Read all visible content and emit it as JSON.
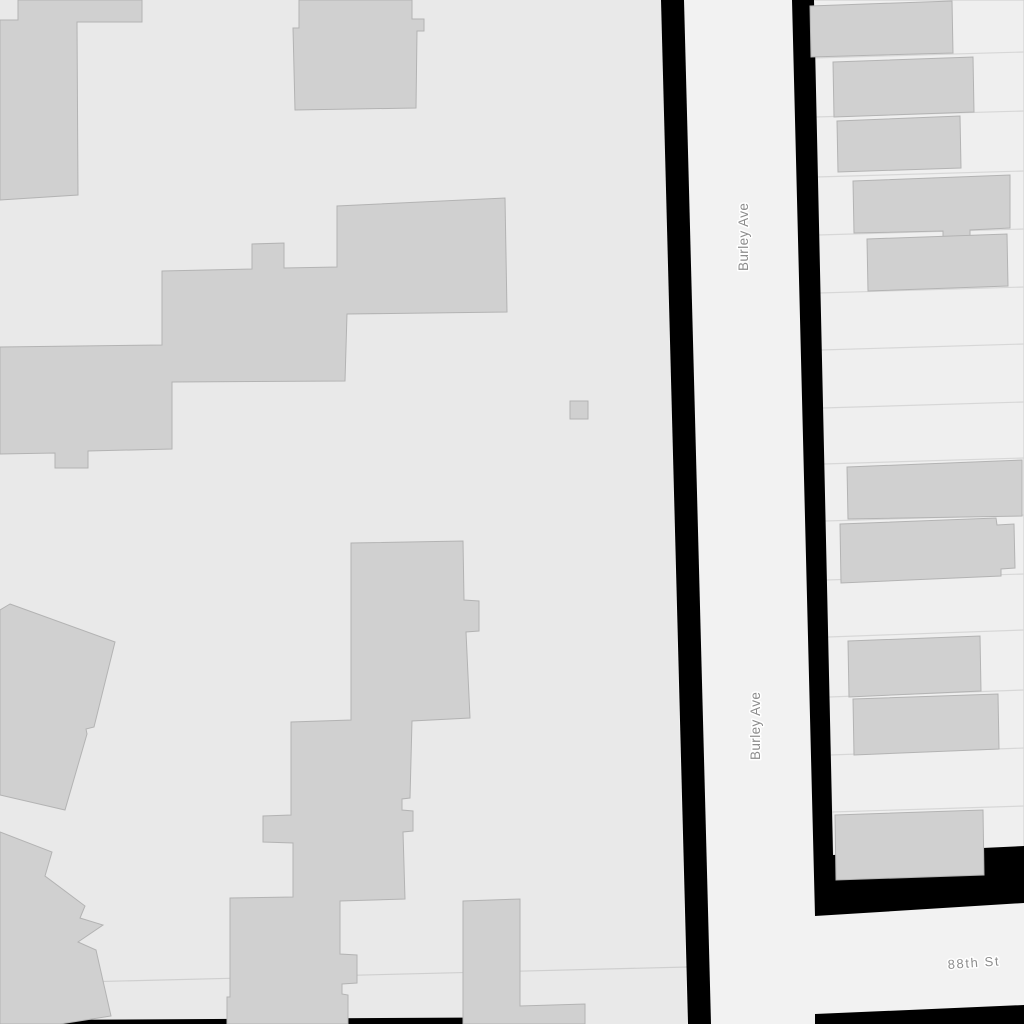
{
  "map": {
    "canvas": {
      "width": 1024,
      "height": 1024
    },
    "colors": {
      "background": "#e9e9e9",
      "road_fill": "#f2f2f2",
      "block_fill": "#efefef",
      "block_stroke": "#cccccc",
      "building_fill": "#d0d0d0",
      "building_stroke": "#b3b3b3",
      "casing": "#000000",
      "parcel_line": "#d7d7d7",
      "boundary_line": "#cfcfcf",
      "label_color": "#8c8c8c",
      "label_halo": "#ffffff"
    },
    "streets": {
      "burley_ave": {
        "name": "Burley Ave",
        "orientation": "vertical"
      },
      "eighty_eighth_st": {
        "name": "88th St",
        "orientation": "horizontal"
      }
    },
    "street_labels": [
      {
        "street": "burley-ave",
        "text": "Burley Ave",
        "x": 748,
        "y": 271,
        "rotate": -90,
        "size": 13.5,
        "spacing": 0.4
      },
      {
        "street": "burley-ave",
        "text": "Burley Ave",
        "x": 760,
        "y": 760,
        "rotate": -90,
        "size": 13.5,
        "spacing": 0.4
      },
      {
        "street": "88th-st",
        "text": "88th St",
        "x": 948,
        "y": 969,
        "rotate": -4,
        "size": 13,
        "spacing": 1.6
      }
    ],
    "roads": [
      {
        "name": "burley-ave-surface",
        "points": [
          [
            661,
            0
          ],
          [
            814,
            0
          ],
          [
            840,
            1024
          ],
          [
            687,
            1024
          ]
        ]
      },
      {
        "name": "88th-st-surface",
        "points": [
          [
            812,
            840
          ],
          [
            1024,
            833
          ],
          [
            1024,
            1024
          ],
          [
            816,
            1024
          ]
        ]
      }
    ],
    "blocks": [
      {
        "name": "east-block",
        "points": [
          [
            812,
            0
          ],
          [
            1024,
            0
          ],
          [
            1024,
            850
          ],
          [
            833,
            860
          ]
        ]
      }
    ],
    "parcel_lines": [
      [
        813,
        58,
        1024,
        52
      ],
      [
        815,
        117,
        1024,
        111
      ],
      [
        816,
        177,
        1024,
        171
      ],
      [
        818,
        235,
        1024,
        229
      ],
      [
        819,
        293,
        1024,
        287
      ],
      [
        821,
        350,
        1024,
        344
      ],
      [
        822,
        408,
        1024,
        402
      ],
      [
        823,
        464,
        1024,
        458
      ],
      [
        825,
        521,
        1024,
        515
      ],
      [
        826,
        580,
        1024,
        574
      ],
      [
        828,
        637,
        1024,
        630
      ],
      [
        829,
        697,
        1024,
        690
      ],
      [
        830,
        755,
        1024,
        748
      ],
      [
        832,
        812,
        1024,
        806
      ],
      [
        0,
        984,
        688,
        967
      ]
    ],
    "casings": [
      {
        "name": "burley-ave-casing-west",
        "points": [
          [
            661,
            0
          ],
          [
            684,
            0
          ],
          [
            711,
            1024
          ],
          [
            688,
            1024
          ]
        ]
      },
      {
        "name": "burley-ave-88th-casing-corner",
        "points": [
          [
            792,
            0
          ],
          [
            814,
            0
          ],
          [
            833,
            855
          ],
          [
            1024,
            846
          ],
          [
            1024,
            903
          ],
          [
            815,
            916
          ]
        ]
      },
      {
        "name": "88th-st-casing-south",
        "points": [
          [
            815,
            1014
          ],
          [
            1024,
            1005
          ],
          [
            1024,
            1024
          ],
          [
            815,
            1024
          ]
        ]
      },
      {
        "name": "south-street-casing-edge",
        "points": [
          [
            28,
            1020
          ],
          [
            566,
            1017
          ],
          [
            566,
            1024
          ],
          [
            28,
            1024
          ]
        ]
      }
    ],
    "buildings": [
      {
        "name": "building-northwest",
        "points": [
          [
            18,
            0
          ],
          [
            142,
            0
          ],
          [
            142,
            22
          ],
          [
            77,
            22
          ],
          [
            78,
            195
          ],
          [
            0,
            200
          ],
          [
            0,
            20
          ],
          [
            18,
            20
          ]
        ]
      },
      {
        "name": "building-north-middle",
        "points": [
          [
            293,
            28
          ],
          [
            299,
            28
          ],
          [
            299,
            0
          ],
          [
            412,
            0
          ],
          [
            412,
            19
          ],
          [
            424,
            19
          ],
          [
            424,
            31
          ],
          [
            417,
            31
          ],
          [
            416,
            108
          ],
          [
            295,
            110
          ]
        ]
      },
      {
        "name": "building-central-complex",
        "points": [
          [
            0,
            347
          ],
          [
            162,
            345
          ],
          [
            162,
            271
          ],
          [
            252,
            269
          ],
          [
            252,
            244
          ],
          [
            284,
            243
          ],
          [
            284,
            268
          ],
          [
            337,
            267
          ],
          [
            337,
            206
          ],
          [
            505,
            198
          ],
          [
            507,
            312
          ],
          [
            347,
            314
          ],
          [
            345,
            381
          ],
          [
            172,
            382
          ],
          [
            172,
            449
          ],
          [
            88,
            451
          ],
          [
            88,
            468
          ],
          [
            55,
            468
          ],
          [
            55,
            453
          ],
          [
            0,
            454
          ]
        ]
      },
      {
        "name": "building-small-square",
        "points": [
          [
            570,
            401
          ],
          [
            588,
            401
          ],
          [
            588,
            419
          ],
          [
            570,
            419
          ]
        ]
      },
      {
        "name": "building-south-central-complex",
        "points": [
          [
            351,
            543
          ],
          [
            463,
            541
          ],
          [
            464,
            600
          ],
          [
            479,
            601
          ],
          [
            479,
            631
          ],
          [
            466,
            632
          ],
          [
            470,
            718
          ],
          [
            412,
            721
          ],
          [
            410,
            798
          ],
          [
            402,
            799
          ],
          [
            402,
            810
          ],
          [
            413,
            811
          ],
          [
            413,
            831
          ],
          [
            403,
            832
          ],
          [
            405,
            899
          ],
          [
            340,
            901
          ],
          [
            340,
            954
          ],
          [
            357,
            955
          ],
          [
            357,
            983
          ],
          [
            342,
            984
          ],
          [
            342,
            994
          ],
          [
            348,
            995
          ],
          [
            348,
            1024
          ],
          [
            227,
            1024
          ],
          [
            227,
            997
          ],
          [
            230,
            997
          ],
          [
            230,
            898
          ],
          [
            293,
            897
          ],
          [
            293,
            843
          ],
          [
            263,
            842
          ],
          [
            263,
            816
          ],
          [
            291,
            815
          ],
          [
            291,
            722
          ],
          [
            351,
            720
          ]
        ]
      },
      {
        "name": "building-southwest-upper",
        "points": [
          [
            10,
            604
          ],
          [
            115,
            642
          ],
          [
            94,
            727
          ],
          [
            86,
            729
          ],
          [
            87,
            734
          ],
          [
            65,
            810
          ],
          [
            0,
            795
          ],
          [
            0,
            610
          ]
        ]
      },
      {
        "name": "building-southwest-lower",
        "points": [
          [
            0,
            832
          ],
          [
            52,
            852
          ],
          [
            45,
            876
          ],
          [
            85,
            906
          ],
          [
            80,
            918
          ],
          [
            103,
            925
          ],
          [
            78,
            942
          ],
          [
            96,
            950
          ],
          [
            111,
            1016
          ],
          [
            60,
            1024
          ],
          [
            0,
            1024
          ]
        ]
      },
      {
        "name": "building-south-column",
        "points": [
          [
            463,
            901
          ],
          [
            520,
            899
          ],
          [
            520,
            1006
          ],
          [
            585,
            1004
          ],
          [
            585,
            1024
          ],
          [
            463,
            1024
          ]
        ]
      },
      {
        "name": "building-east-row-1",
        "points": [
          [
            810,
            6
          ],
          [
            952,
            1
          ],
          [
            953,
            53
          ],
          [
            811,
            57
          ]
        ]
      },
      {
        "name": "building-east-row-2",
        "points": [
          [
            833,
            62
          ],
          [
            973,
            57
          ],
          [
            974,
            112
          ],
          [
            834,
            117
          ]
        ]
      },
      {
        "name": "building-east-row-3",
        "points": [
          [
            837,
            121
          ],
          [
            960,
            116
          ],
          [
            961,
            168
          ],
          [
            838,
            172
          ]
        ]
      },
      {
        "name": "building-east-row-4",
        "points": [
          [
            853,
            181
          ],
          [
            1010,
            175
          ],
          [
            1010,
            228
          ],
          [
            970,
            230
          ],
          [
            970,
            236
          ],
          [
            943,
            237
          ],
          [
            943,
            231
          ],
          [
            854,
            233
          ]
        ]
      },
      {
        "name": "building-east-row-5",
        "points": [
          [
            867,
            239
          ],
          [
            1007,
            234
          ],
          [
            1008,
            286
          ],
          [
            868,
            291
          ]
        ]
      },
      {
        "name": "building-east-row-6",
        "points": [
          [
            847,
            467
          ],
          [
            1022,
            460
          ],
          [
            1022,
            516
          ],
          [
            848,
            519
          ]
        ]
      },
      {
        "name": "building-east-row-7",
        "points": [
          [
            840,
            524
          ],
          [
            996,
            518
          ],
          [
            997,
            525
          ],
          [
            1014,
            524
          ],
          [
            1015,
            568
          ],
          [
            1001,
            569
          ],
          [
            1001,
            576
          ],
          [
            841,
            583
          ]
        ]
      },
      {
        "name": "building-east-row-8",
        "points": [
          [
            848,
            641
          ],
          [
            980,
            636
          ],
          [
            981,
            691
          ],
          [
            849,
            697
          ]
        ]
      },
      {
        "name": "building-east-row-9",
        "points": [
          [
            853,
            699
          ],
          [
            998,
            694
          ],
          [
            999,
            749
          ],
          [
            854,
            755
          ]
        ]
      },
      {
        "name": "building-east-corner",
        "points": [
          [
            835,
            815
          ],
          [
            983,
            810
          ],
          [
            984,
            875
          ],
          [
            836,
            880
          ]
        ]
      }
    ]
  }
}
